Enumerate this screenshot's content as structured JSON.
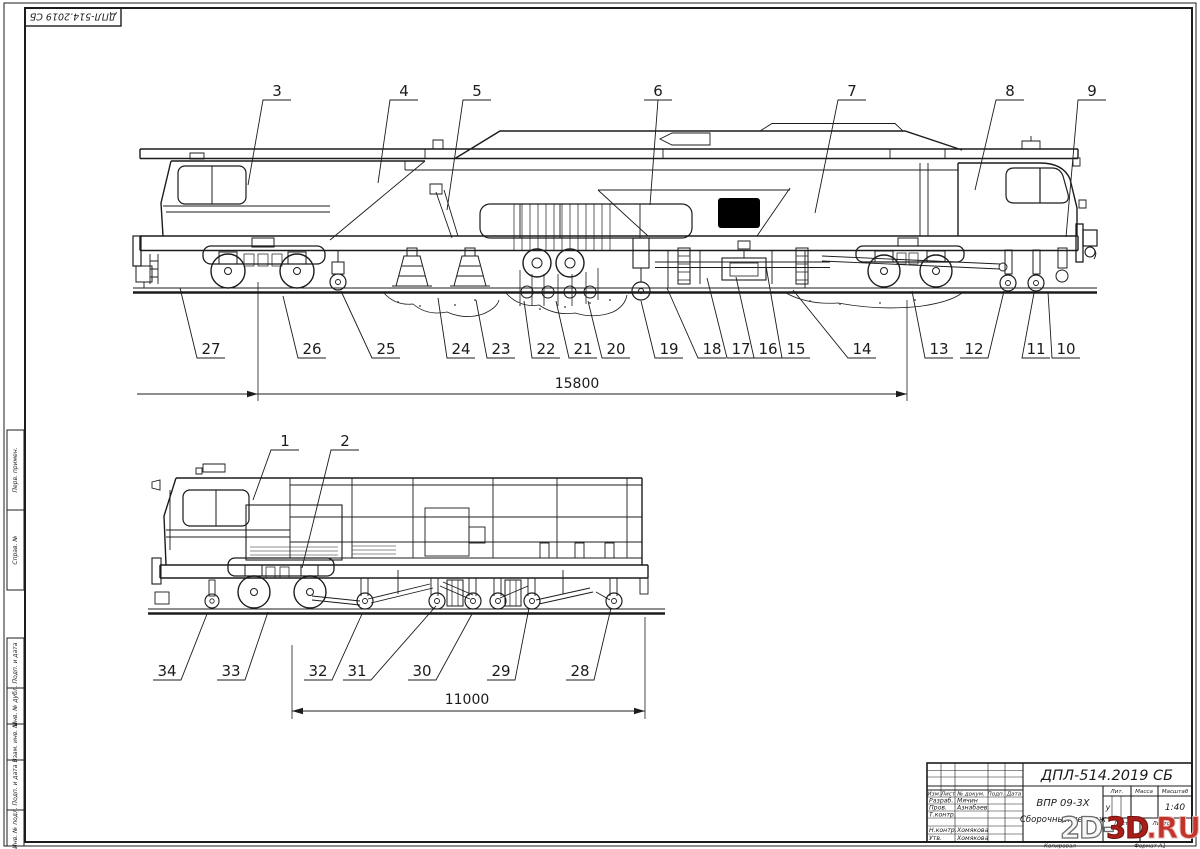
{
  "corner_stamp": "ДПЛ-514.2019 СБ",
  "side_margin": {
    "perv_primen": "Перв. примен.",
    "sprav_no": "Справ. №",
    "podp_data_1": "Подп. и дата",
    "inv_dubl": "Инв. № дубл.",
    "vzam_inv": "Взам. инв. №",
    "podp_data_2": "Подп. и дата",
    "inv_podl": "Инв. № подл."
  },
  "top_view": {
    "callouts_top": [
      "3",
      "4",
      "5",
      "6",
      "7",
      "8",
      "9"
    ],
    "callouts_bottom": [
      "27",
      "26",
      "25",
      "24",
      "23",
      "22",
      "21",
      "20",
      "19",
      "18",
      "17",
      "16",
      "15",
      "14",
      "13",
      "12",
      "11",
      "10"
    ],
    "dimension": "15800"
  },
  "bottom_view": {
    "callouts_top": [
      "1",
      "2"
    ],
    "callouts_bottom": [
      "34",
      "33",
      "32",
      "31",
      "30",
      "29",
      "28"
    ],
    "dimension": "11000"
  },
  "title_block": {
    "designation": "ДПЛ-514.2019 СБ",
    "product_name": "ВПР 09-3Х",
    "doc_type": "Сборочный чертеж",
    "col_izm": "Изм.",
    "col_list": "Лист",
    "col_doc": "№ докум.",
    "col_podp": "Подп.",
    "col_data": "Дата",
    "row_razrab": "Разраб.",
    "razrab_name": "Мячин",
    "row_prov": "Пров.",
    "prov_name": "Азнабаев",
    "row_tkontr": "Т.контр.",
    "row_nkontr": "Н.контр.",
    "nkontr_name": "Хомякова",
    "row_utv": "Утв.",
    "utv_name": "Хомякова",
    "lit_label": "Лит.",
    "lit_value": "у",
    "mass_label": "Масса",
    "scale_label": "Масштаб",
    "scale_value": "1:40",
    "sheet_label": "Лист",
    "sheets_label": "Листов",
    "copied": "Копировал",
    "format": "Формат  А1"
  },
  "watermark": {
    "part_1": "2D-",
    "part_2": "3D",
    "part_3": ".RU"
  }
}
